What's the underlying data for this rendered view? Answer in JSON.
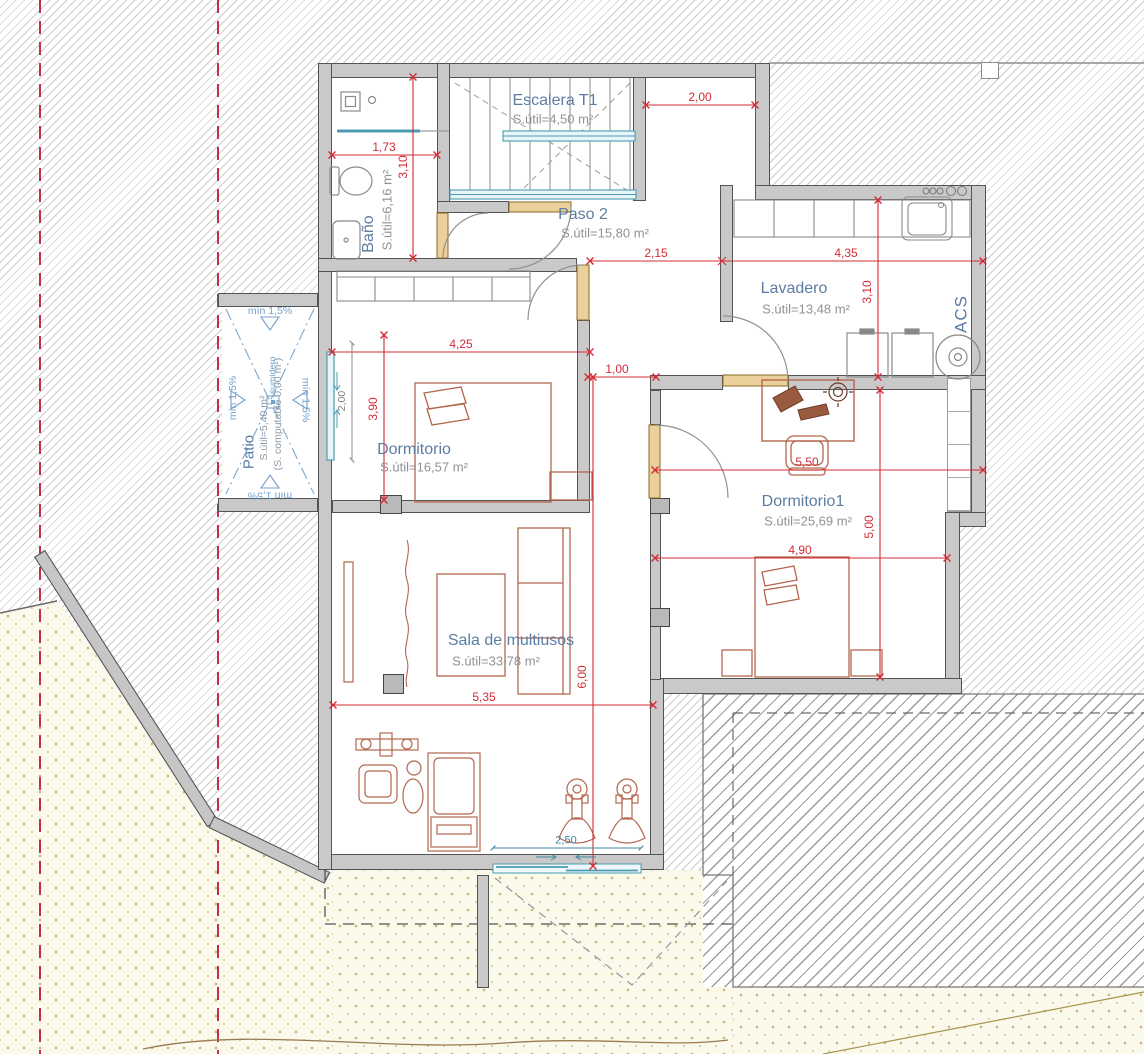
{
  "plan": {
    "rooms": {
      "escalera": {
        "name": "Escalera T1",
        "area": "S.útil=4,50 m²"
      },
      "paso": {
        "name": "Paso 2",
        "area": "S.útil=15,80 m²"
      },
      "bano": {
        "name": "Baño",
        "area": "S.útil=6,16 m²"
      },
      "lavadero": {
        "name": "Lavadero",
        "area": "S.útil=13,48 m²"
      },
      "dormitorio": {
        "name": "Dormitorio",
        "area": "S.útil=16,57 m²"
      },
      "dormitorio1": {
        "name": "Dormitorio1",
        "area": "S.útil=25,69 m²"
      },
      "sala": {
        "name": "Sala de multiusos",
        "area": "S.útil=33,78 m²"
      },
      "patio": {
        "name": "Patio",
        "area": "S.útil=5,40 m²",
        "computable": "(S. computable 0,00 m²)",
        "slope": "mín 1,5%",
        "drain": "sumidero"
      }
    },
    "equipment": {
      "acs_label": "ACS"
    },
    "dimensions": {
      "top_width": "2,00",
      "bano_width": "1,73",
      "bano_depth": "3,10",
      "paso_width": "2,15",
      "lavadero_width": "4,35",
      "lavadero_depth": "3,10",
      "dormitorio_width": "4,25",
      "dormitorio_depth": "3,90",
      "window_width": "2,00",
      "hall_width": "1,00",
      "dormitorio1_width": "5,50",
      "dormitorio1_depth": "5,00",
      "bed_wall_width": "4,90",
      "sala_width": "5,35",
      "sala_depth": "6,00",
      "door_width": "2,50"
    },
    "colors": {
      "dimension_red": "#d32b36",
      "label_blue": "#5c7da2",
      "glazing_teal": "#4b9cb2",
      "patio_blue": "#74a0cc",
      "wall_gray": "#c9c9c9",
      "terrain_dot": "#c3b766",
      "door_tan": "#ecd09c",
      "boundary_red": "#c13048",
      "furniture_brown": "#b2664c"
    }
  }
}
